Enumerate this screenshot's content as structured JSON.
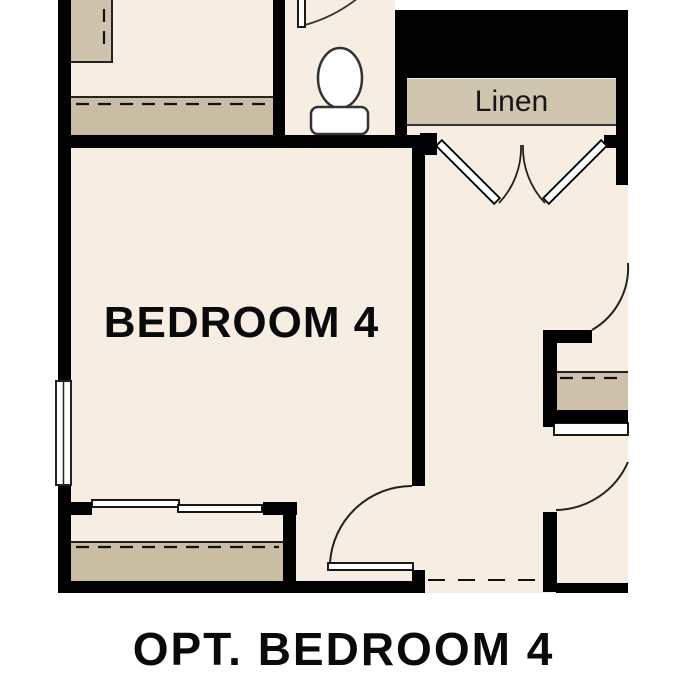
{
  "plan": {
    "caption": "OPT. BEDROOM 4",
    "rooms": [
      {
        "name": "bedroom-4",
        "label": "BEDROOM 4"
      },
      {
        "name": "linen-closet",
        "label": "Linen"
      }
    ],
    "symbols": [
      "toilet-plan-symbol",
      "window-plan-symbol",
      "double-swing-door-symbol",
      "swing-door-symbol",
      "bypass-closet-door-symbol",
      "closet-shelf-and-rod-symbol",
      "optional-wall-dashed-line"
    ],
    "palette": {
      "wall": "#000000",
      "floor": "#f6eee3",
      "shelf_tan": "#c9bda4",
      "band_tan": "#d0c5af",
      "line": "#1a1a1a",
      "fixture_stroke": "#333333",
      "background": "#ffffff"
    }
  }
}
